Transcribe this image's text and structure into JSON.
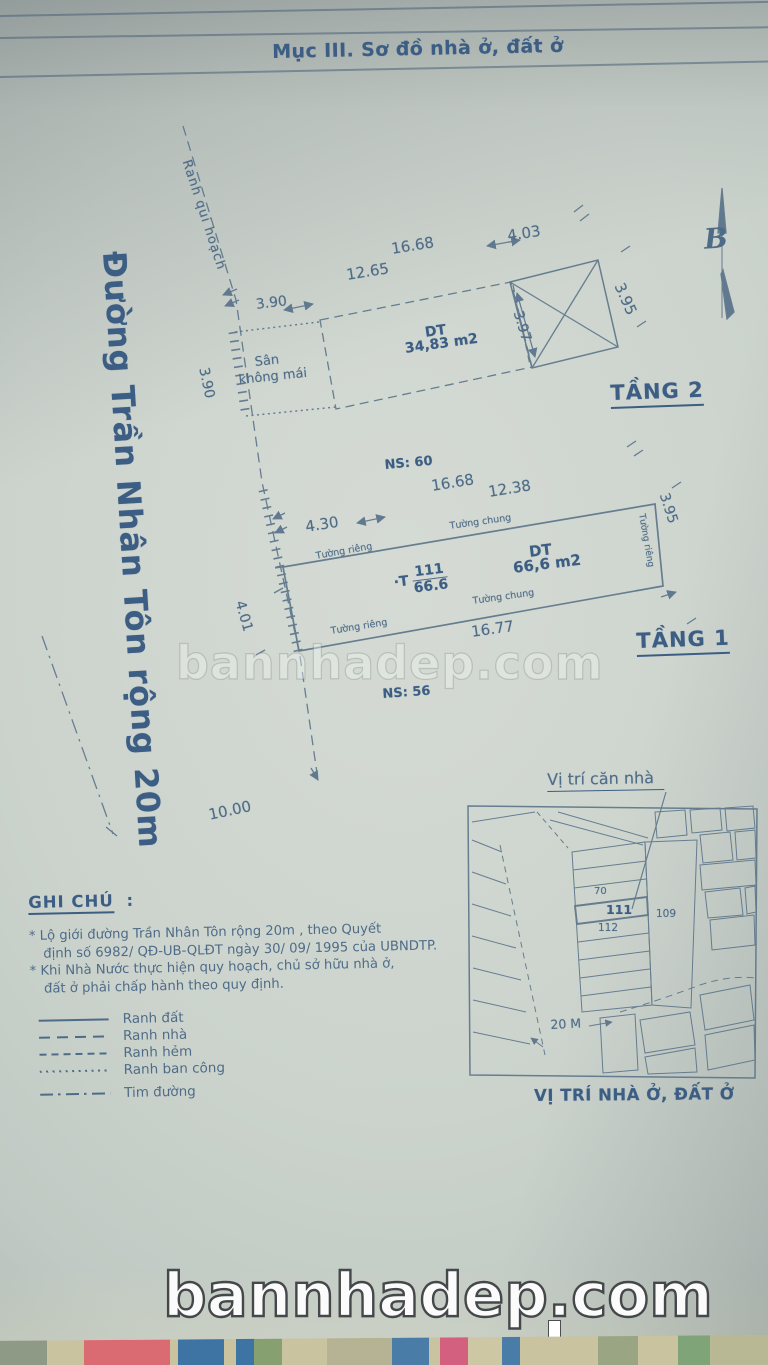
{
  "colors": {
    "ink": "#4e6c88",
    "ink_dark": "#3c5d84",
    "paper": "#ccd3cd"
  },
  "header": {
    "title": "Mục III. Sơ đồ nhà ở, đất ở"
  },
  "compass": {
    "letter": "B"
  },
  "site": {
    "planning_boundary": "Ranh qui hoạch",
    "road_name": "Đường Trần Nhân Tôn  rộng  20m",
    "dim_road_frontage": "10.00"
  },
  "floor2": {
    "label": "TẦNG 2",
    "area_label": "DT",
    "area_value": "34,83 m2",
    "yard_line1": "Sân",
    "yard_line2": "không mái",
    "dim_top_outer": "16.68",
    "dim_top_inner": "12.65",
    "dim_top_right": "4.03",
    "dim_left_top": "3.90",
    "dim_left_side": "3.90",
    "dim_cross_width": "3.97",
    "dim_right_side": "3.95"
  },
  "floor1": {
    "label": "TẦNG 1",
    "neighbor_top": "NS: 60",
    "neighbor_bottom": "NS: 56",
    "area_label": "DT",
    "area_value": "66,6 m2",
    "lot_prefix": "·T",
    "lot_number": "111",
    "lot_area": "66.6",
    "wall_shared_top": "Tường chung",
    "wall_shared_bottom": "Tường chung",
    "wall_private_top_left": "Tường riêng",
    "wall_private_bottom_left": "Tường riêng",
    "wall_private_right": "Tường riêng",
    "dim_top_outer": "16.68",
    "dim_top_inner": "12.38",
    "dim_left_top": "4.30",
    "dim_left_side": "4.01",
    "dim_bottom": "16.77",
    "dim_right_side": "3.95"
  },
  "notes": {
    "title": "GHI CHÚ",
    "colon": ":",
    "lines": [
      "* Lộ giới đường Trần Nhân Tôn  rộng 20m , theo Quyết",
      "định số 6982/ QĐ-UB-QLĐT   ngày 30/ 09/ 1995 của UBNDTP.",
      "* Khi Nhà Nước thực hiện quy hoạch, chủ sở hữu nhà ở,",
      "đất ở phải chấp hành theo quy định."
    ],
    "legend": [
      {
        "label": "Ranh đất"
      },
      {
        "label": "Ranh nhà"
      },
      {
        "label": "Ranh hẻm"
      },
      {
        "label": "Ranh ban công"
      },
      {
        "label": "Tim đường"
      }
    ]
  },
  "map": {
    "pointer_title": "Vị trí căn nhà",
    "caption": "VỊ TRÍ NHÀ Ở, ĐẤT Ở",
    "scale_label": "20 M",
    "lot_70": "70",
    "lot_111": "111",
    "lot_112": "112",
    "lot_109": "109"
  },
  "watermark": {
    "center": "bannhadep.com",
    "bottom": "bannhadep.com"
  }
}
